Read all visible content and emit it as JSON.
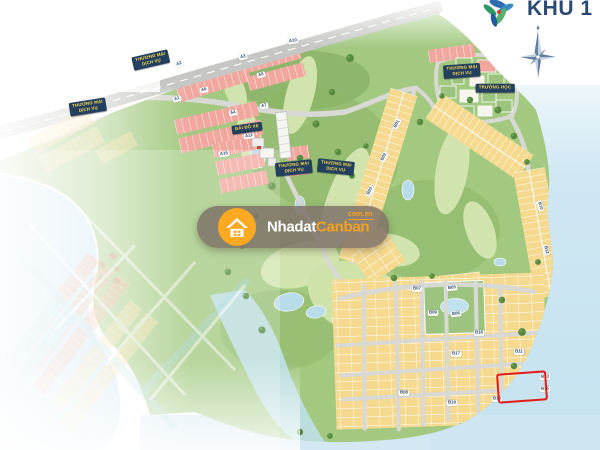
{
  "map": {
    "zone_title": "KHU 1",
    "watermark": {
      "brand_white": "Nhadat",
      "brand_orange": "Canban",
      "domain": "com.vn",
      "icon": "house-icon"
    },
    "icons": {
      "watermark": "house-icon",
      "compass": "compass-rose-icon",
      "logo": "brand-logo-icon"
    },
    "area_labels": [
      {
        "lines": [
          "THƯƠNG MẠI",
          "DỊCH VỤ"
        ],
        "x": 151,
        "y": 60,
        "rot": -13
      },
      {
        "lines": [
          "THƯƠNG MẠI",
          "DỊCH VỤ"
        ],
        "x": 88,
        "y": 107,
        "rot": -9
      },
      {
        "lines": [
          "THƯƠNG MẠI",
          "DỊCH VỤ"
        ],
        "x": 294,
        "y": 168,
        "rot": -6
      },
      {
        "lines": [
          "THƯƠNG MẠI",
          "DỊCH VỤ"
        ],
        "x": 336,
        "y": 167,
        "rot": 6
      },
      {
        "lines": [
          "THƯƠNG MẠI",
          "DỊCH VỤ"
        ],
        "x": 462,
        "y": 71,
        "rot": -4
      },
      {
        "lines": [
          "TRƯỜNG HỌC"
        ],
        "x": 495,
        "y": 88,
        "rot": 0
      },
      {
        "lines": [
          "BÃI ĐỖ XE"
        ],
        "x": 247,
        "y": 128,
        "rot": -8
      }
    ],
    "road_badges": [
      {
        "label": "A2",
        "x": 179,
        "y": 64,
        "rot": -18
      },
      {
        "label": "A3",
        "x": 243,
        "y": 57,
        "rot": -14
      },
      {
        "label": "A10",
        "x": 293,
        "y": 41,
        "rot": -8
      },
      {
        "label": "A5",
        "x": 261,
        "y": 75,
        "rot": -14
      },
      {
        "label": "A6",
        "x": 204,
        "y": 90,
        "rot": -16
      },
      {
        "label": "A1",
        "x": 177,
        "y": 99,
        "rot": -18
      },
      {
        "label": "A7",
        "x": 264,
        "y": 106,
        "rot": -12
      },
      {
        "label": "A4",
        "x": 233,
        "y": 113,
        "rot": -14
      },
      {
        "label": "A12",
        "x": 249,
        "y": 136,
        "rot": -10
      },
      {
        "label": "A15",
        "x": 224,
        "y": 154,
        "rot": -8
      },
      {
        "label": "B01",
        "x": 397,
        "y": 124,
        "rot": -62
      },
      {
        "label": "B02",
        "x": 384,
        "y": 157,
        "rot": -62
      },
      {
        "label": "B03",
        "x": 370,
        "y": 191,
        "rot": -62
      },
      {
        "label": "B04",
        "x": 358,
        "y": 226,
        "rot": -62
      },
      {
        "label": "B05",
        "x": 452,
        "y": 288,
        "rot": -6
      },
      {
        "label": "B06",
        "x": 456,
        "y": 314,
        "rot": -6
      },
      {
        "label": "B10",
        "x": 540,
        "y": 206,
        "rot": 72
      },
      {
        "label": "B12",
        "x": 546,
        "y": 250,
        "rot": 76
      },
      {
        "label": "B07",
        "x": 417,
        "y": 289,
        "rot": 0
      },
      {
        "label": "B09",
        "x": 433,
        "y": 313,
        "rot": 0
      },
      {
        "label": "B16",
        "x": 479,
        "y": 333,
        "rot": 0
      },
      {
        "label": "B17",
        "x": 456,
        "y": 354,
        "rot": 0
      },
      {
        "label": "B11",
        "x": 519,
        "y": 352,
        "rot": 0
      },
      {
        "label": "B13",
        "x": 545,
        "y": 377,
        "rot": -3
      },
      {
        "label": "B15",
        "x": 545,
        "y": 389,
        "rot": -3
      },
      {
        "label": "B08",
        "x": 404,
        "y": 393,
        "rot": 0
      },
      {
        "label": "B19",
        "x": 452,
        "y": 403,
        "rot": 0
      },
      {
        "label": "B18",
        "x": 497,
        "y": 399,
        "rot": 0
      }
    ],
    "highlight": {
      "x": 497,
      "y": 372,
      "w": 46,
      "h": 26,
      "rot": -4,
      "color": "#e21b1b"
    },
    "colors": {
      "highlight_red": "#e21b1b",
      "area_label_bg": "#23405e",
      "area_label_text": "#ffd94e",
      "brand_orange": "#f6a21e",
      "title_navy": "#2a4a74",
      "water": "#c9e4f1",
      "golf_green": "#a3c981",
      "lot_yellow": "#f5d98e",
      "lot_pink": "#f1a79e"
    }
  }
}
